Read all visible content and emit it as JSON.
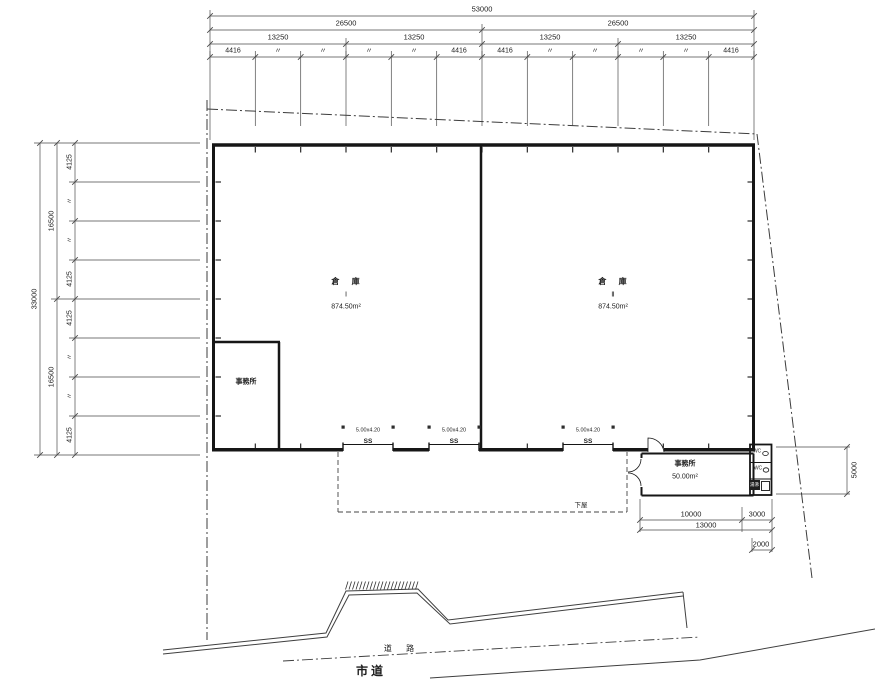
{
  "plan": {
    "dims_top": {
      "total": "53000",
      "halves": [
        "26500",
        "26500"
      ],
      "quarters": [
        "13250",
        "13250",
        "13250",
        "13250"
      ],
      "cells": [
        "4416",
        "〃",
        "〃",
        "〃",
        "〃",
        "4416",
        "4416",
        "〃",
        "〃",
        "〃",
        "〃",
        "4416"
      ]
    },
    "dims_left": {
      "total": "33000",
      "halves": [
        "16500",
        "16500"
      ],
      "cells": [
        "4125",
        "〃",
        "〃",
        "4125",
        "4125",
        "〃",
        "〃",
        "4125"
      ]
    },
    "dims_right": {
      "depth": "5000"
    },
    "dims_bottom": {
      "office_w": "10000",
      "annex_w": "3000",
      "total_w": "13000",
      "wc_w": "2000"
    },
    "rooms": {
      "warehouse_left": {
        "name": "倉 庫",
        "number": "Ⅰ",
        "area": "874.50m²"
      },
      "warehouse_right": {
        "name": "倉 庫",
        "number": "Ⅱ",
        "area": "874.50m²"
      },
      "office_left": {
        "name": "事務所"
      },
      "office_right": {
        "name": "事務所",
        "area": "50.00m²"
      },
      "wc_upper": "WC",
      "wc_lower": "WC",
      "hot_water": "湯沸",
      "canopy": "下屋"
    },
    "shutters": [
      {
        "size": "5.00x4.20",
        "mark": "SS"
      },
      {
        "size": "5.00x4.20",
        "mark": "SS"
      },
      {
        "size": "5.00x4.20",
        "mark": "SS"
      }
    ],
    "roads": {
      "road": "道 路",
      "city_road": "市道"
    }
  }
}
